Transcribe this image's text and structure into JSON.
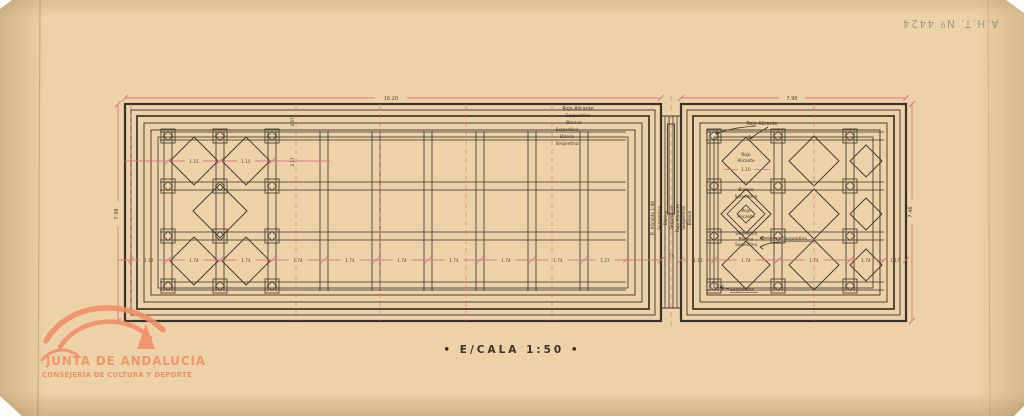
{
  "colors": {
    "paper": "#ecd2a6",
    "ink": "#3a322a",
    "dim": "#d96b82",
    "pencil": "#95907e",
    "logo": "#f28d69",
    "dimtext": "#53443a",
    "white": "#fbfbf9"
  },
  "inscription": "A.H.T. Nº 4424",
  "scale": "• E/CALA 1:50 •",
  "logo": {
    "title": "JUNTA DE ANDALUCIA",
    "subtitle": "CONSEJERÍA DE CULTURA Y DEPORTE"
  },
  "plan_left": {
    "band_labels": [
      "Rojo Alicante",
      "Serpentina",
      "Blanco",
      "Serpentina",
      "Blanco",
      "Serpentina"
    ],
    "diamond_dim_1": "1.15",
    "diamond_dim_2": "1.15",
    "vert_dim_1": "4.57",
    "vert_dim_2": "2.17"
  },
  "strip_labels": [
    "R. Alicante 1.98",
    "Serpentina",
    "Blanco",
    "Serpentina",
    "Rojo Alicante",
    "Serpentina",
    "Blanco"
  ],
  "plan_right": {
    "top_label": "Rojo Alicante",
    "d1_line1": "Rojo",
    "d1_line2": "Alicante",
    "d1_dim": "1.10",
    "band1": "Blanco",
    "band2": "Serpentina",
    "center_line1": "Rojo",
    "center_line2": "Alicante",
    "below1": "Serpentina",
    "below2": "Blanco",
    "below3": "Serpentina",
    "right_arrow_label": "Serpentina",
    "bottom_arrow_label": "Serpentina"
  },
  "dims": {
    "top_left": "16.20",
    "top_right": "7.96",
    "left_h": "7.98",
    "right_h": "7.46",
    "gap": ".75",
    "row_left": [
      "1.57",
      "1.74",
      "1.74",
      "1.74",
      "1.74",
      "1.74",
      "1.74",
      "1.74",
      "1.74",
      "1.27"
    ],
    "row_right": [
      "1.13",
      "1.74",
      "1.74",
      "1.74",
      "1.17"
    ]
  }
}
